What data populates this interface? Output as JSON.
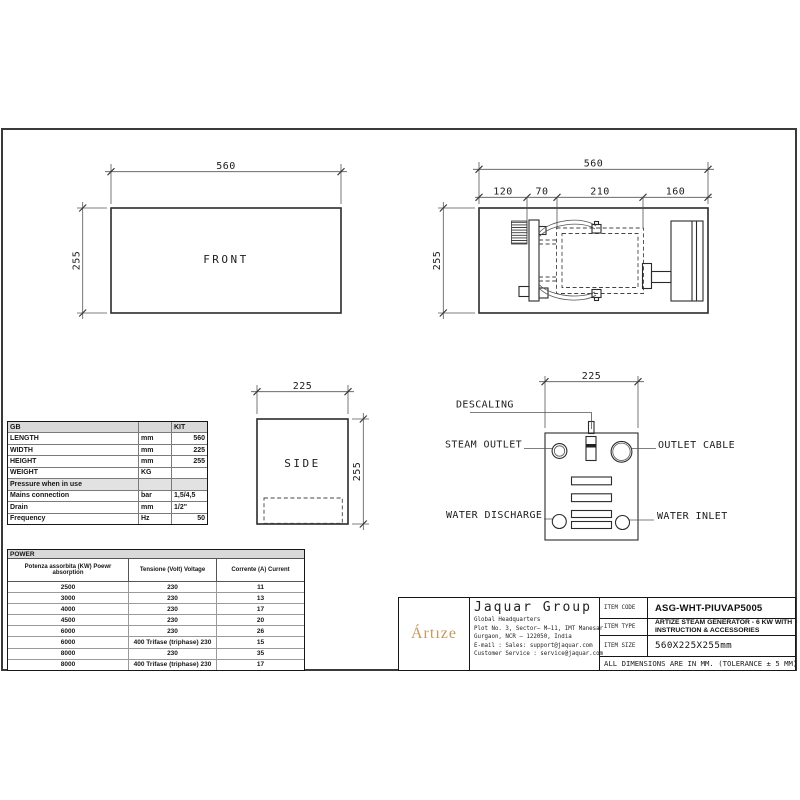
{
  "page": {
    "background": "#ffffff",
    "line_color": "#2b2b2b",
    "accent_gold": "#c49a62",
    "header_gray": "#d9d9d9"
  },
  "views": {
    "front": {
      "label": "FRONT",
      "width_dim": "560",
      "height_dim": "255"
    },
    "top": {
      "width_dim": "560",
      "height_dim": "255",
      "segments": [
        "120",
        "70",
        "210",
        "160"
      ]
    },
    "side": {
      "label": "SIDE",
      "width_dim": "225",
      "height_dim": "255"
    },
    "connections": {
      "width_dim": "225",
      "descaling": "DESCALING",
      "steam_outlet": "STEAM OUTLET",
      "outlet_cable": "OUTLET CABLE",
      "water_discharge": "WATER DISCHARGE",
      "water_inlet": "WATER INLET"
    }
  },
  "spec_table": {
    "header": {
      "col1": "GB",
      "col2": "",
      "col3": "KIT"
    },
    "rows": [
      {
        "name": "LENGTH",
        "unit": "mm",
        "value": "560"
      },
      {
        "name": "WIDTH",
        "unit": "mm",
        "value": "225"
      },
      {
        "name": "HEIGHT",
        "unit": "mm",
        "value": "255"
      },
      {
        "name": "WEIGHT",
        "unit": "KG",
        "value": ""
      },
      {
        "name": "Pressure when in use",
        "unit": "",
        "value": ""
      },
      {
        "name": "Mains connection",
        "unit": "bar",
        "value": "1,5/4,5"
      },
      {
        "name": "Drain",
        "unit": "mm",
        "value": "1/2\""
      },
      {
        "name": "Frequency",
        "unit": "Hz",
        "value": "50"
      }
    ]
  },
  "power_table": {
    "title": "POWER",
    "columns": [
      "Potenza assorbita (KW) Poewr absorption",
      "Tensione (Volt) Voltage",
      "Corrente (A) Current"
    ],
    "rows": [
      [
        "2500",
        "230",
        "11"
      ],
      [
        "3000",
        "230",
        "13"
      ],
      [
        "4000",
        "230",
        "17"
      ],
      [
        "4500",
        "230",
        "20"
      ],
      [
        "6000",
        "230",
        "26"
      ],
      [
        "6000",
        "400 Trifase (triphase) 230",
        "15"
      ],
      [
        "8000",
        "230",
        "35"
      ],
      [
        "8000",
        "400 Trifase (triphase) 230",
        "17"
      ]
    ]
  },
  "title_block": {
    "logo": "Ártıze",
    "company": "Jaquar Group",
    "hq": "Global Headquarters",
    "address1": "Plot No. 3, Sector– M–11, IMT Manesar",
    "address2": "Gurgaon, NCR – 122050, India",
    "email_line": "E-mail : Sales: support@jaquar.com",
    "service_line": "Customer Service : service@jaquar.com",
    "item_code_label": "ITEM CODE",
    "item_code": "ASG-WHT-PIUVAP5005",
    "item_type_label": "ITEM TYPE",
    "item_type_line1": "ARTIZE STEAM GENERATOR -  6 KW WITH",
    "item_type_line2": "INSTRUCTION & ACCESSORIES",
    "item_size_label": "ITEM SIZE",
    "item_size": "560X225X255mm",
    "note": "ALL DIMENSIONS ARE IN MM. (TOLERANCE ± 5 MM)"
  }
}
